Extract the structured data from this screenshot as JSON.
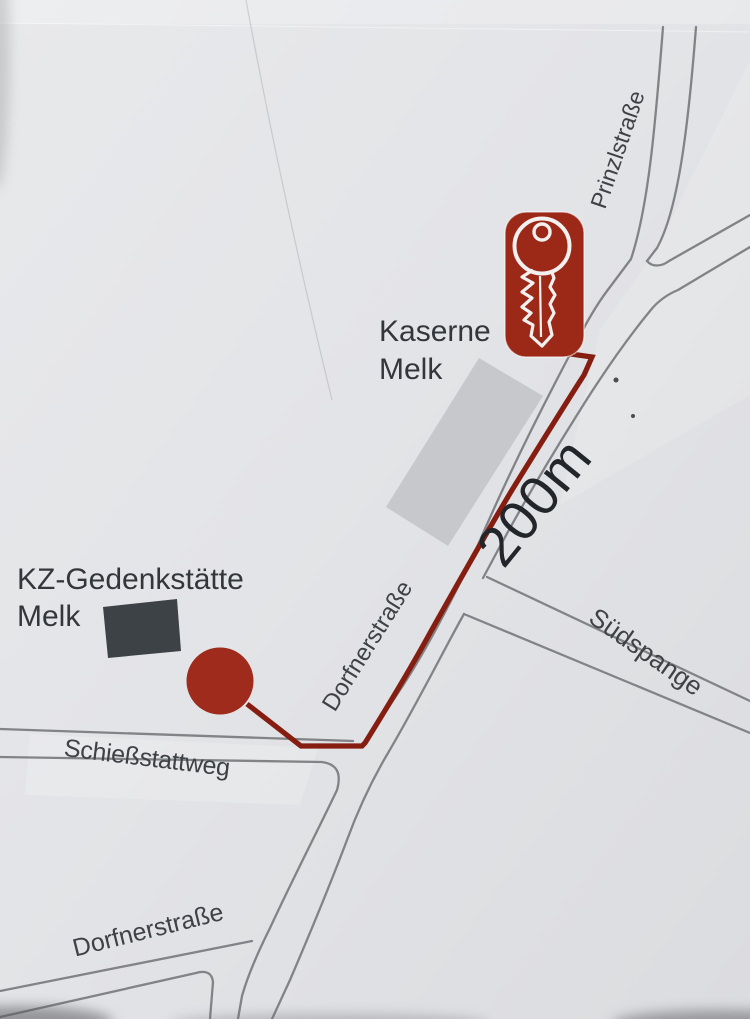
{
  "map": {
    "streets": {
      "prinzlstrasse": "Prinzlstraße",
      "dorfnerstrasse_mid": "Dorfnerstraße",
      "suedspange": "Südspange",
      "schiessstattweg": "Schießstattweg",
      "dorfnerstrasse_bottom": "Dorfnerstraße"
    },
    "landmarks": {
      "kaserne": {
        "line1": "Kaserne",
        "line2": "Melk"
      },
      "memorial": {
        "line1": "KZ-Gedenkstätte",
        "line2": "Melk"
      }
    },
    "route": {
      "distance_label": "200m"
    },
    "icons": {
      "start_badge": "key-icon",
      "destination": "circle-marker"
    },
    "colors": {
      "route_red": "#851e11",
      "marker_red": "#9e2b1c",
      "key_badge_red": "#9c2818",
      "key_glyph_white": "#f3f1ef",
      "road_gray": "#818386",
      "building_gray": "#c7c8cb",
      "memorial_dark": "#3c4246",
      "street_text": "#3e4246",
      "landmark_text": "#33373b",
      "distance_text": "#22252a",
      "background": "#e3e4e6"
    }
  }
}
